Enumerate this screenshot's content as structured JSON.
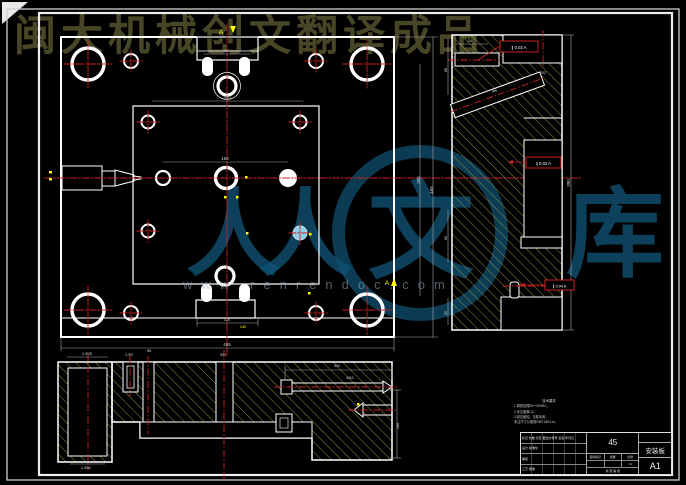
{
  "watermarks": {
    "top_text": "闽大机械创文翻译成品",
    "brand_char_1": "人",
    "brand_char_2": "人",
    "brand_char_3": "文",
    "brand_char_4": "库",
    "url": "www.renrendoc.com"
  },
  "tech_notes": {
    "title": "技术要求",
    "lines": [
      "1.调质处理28～32HRC。",
      "2.未注倒角C2。",
      "3.锐边倒钝，去除毛刺。",
      "未注尺寸公差按GB/T1804-m。"
    ]
  },
  "gdt": [
    {
      "text": "∥ 0.02 A"
    },
    {
      "text": "∥ 0.02 A"
    },
    {
      "text": "∥ 0.04 A"
    }
  ],
  "title_block": {
    "material": "45",
    "part_name": "安装板",
    "sheet_code": "A1",
    "scale": "1:1",
    "stage_row": [
      "阶段标记",
      "质量",
      "比例"
    ],
    "sheet_row": "共 张 第 张",
    "left_rows": [
      "标记 处数 分区 更改文件号 签名 年月日",
      "设计       标准化",
      "审核",
      "工艺       批准"
    ]
  },
  "colors": {
    "background": "#000000",
    "geometry_line": "#ffffff",
    "centerline_red": "#cc2222",
    "hatch_olive": "#9a9a45",
    "dimension_gray": "#d8d8d8",
    "highlight_cyan": "#8ecfe8",
    "accent_yellow": "#ffff00",
    "watermark_blue": "#105274",
    "watermark_olive": "#4d4d2b"
  },
  "dim_labels": [
    {
      "t": "240",
      "x": 227,
      "y": 99
    },
    {
      "t": "150",
      "x": 225,
      "y": 160
    },
    {
      "t": "90",
      "x": 227,
      "y": 52,
      "s": 3.8
    },
    {
      "t": "355",
      "x": 420,
      "y": 180,
      "r": -90
    },
    {
      "t": "465",
      "x": 433,
      "y": 190,
      "r": -90
    },
    {
      "t": "120",
      "x": 227,
      "y": 321,
      "s": 3.8
    },
    {
      "t": "140",
      "x": 243,
      "y": 328,
      "c": "#ffff00",
      "s": 3.8
    },
    {
      "t": "465",
      "x": 227,
      "y": 346
    },
    {
      "t": "24",
      "x": 470,
      "y": 42,
      "s": 3.8
    },
    {
      "t": "85",
      "x": 447,
      "y": 70,
      "r": -90,
      "s": 3.8
    },
    {
      "t": "50",
      "x": 447,
      "y": 238,
      "r": -90,
      "s": 3.8
    },
    {
      "t": "20",
      "x": 447,
      "y": 313,
      "r": -90,
      "s": 3.5
    },
    {
      "t": "Φ6",
      "x": 495,
      "y": 92,
      "r": -20,
      "s": 3.8
    },
    {
      "t": "390",
      "x": 570,
      "y": 183,
      "r": -90
    },
    {
      "t": "202",
      "x": 543,
      "y": 74,
      "s": 3.5
    },
    {
      "t": "1-Φ35",
      "x": 87,
      "y": 355,
      "s": 3.6
    },
    {
      "t": "1-Φ52",
      "x": 86,
      "y": 469,
      "s": 3.6
    },
    {
      "t": "2-Φ9",
      "x": 129,
      "y": 356,
      "s": 3.4
    },
    {
      "t": "Φ6",
      "x": 149,
      "y": 352,
      "s": 3.4
    },
    {
      "t": "Φ11",
      "x": 223,
      "y": 356,
      "s": 3.6
    },
    {
      "t": "302",
      "x": 337,
      "y": 367,
      "s": 3.8
    },
    {
      "t": "M16",
      "x": 350,
      "y": 379,
      "s": 3.6
    },
    {
      "t": "180",
      "x": 399,
      "y": 426,
      "r": -90,
      "s": 3.8
    },
    {
      "t": "A",
      "x": 221,
      "y": 34,
      "c": "#ffff00",
      "s": 6.5
    },
    {
      "t": "A",
      "x": 387,
      "y": 285,
      "c": "#ffff00",
      "s": 6.5
    }
  ]
}
